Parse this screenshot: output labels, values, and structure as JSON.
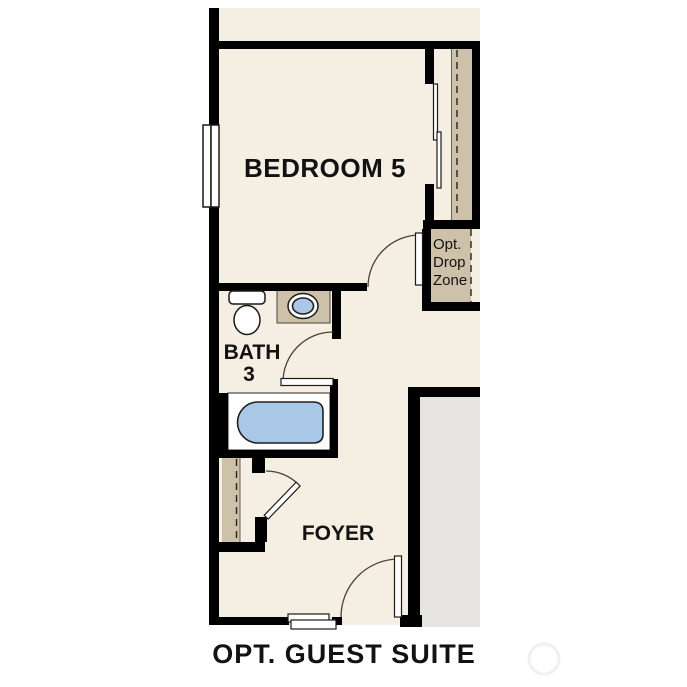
{
  "caption": {
    "title": "OPT. GUEST SUITE"
  },
  "rooms": {
    "bedroom": {
      "label": "BEDROOM 5"
    },
    "bath": {
      "label_line1": "BATH",
      "label_line2": "3"
    },
    "foyer": {
      "label": "FOYER"
    },
    "drop_zone": {
      "label_line1": "Opt.",
      "label_line2": "Drop",
      "label_line3": "Zone"
    }
  },
  "fixtures": {
    "window": "window-icon",
    "sliding_closet_doors": "sliding-door-icon",
    "toilet": "toilet-icon",
    "sink": "sink-icon",
    "bathtub": "bathtub-icon",
    "doors": "door-swing-icon",
    "entry_step": "entry-step-icon"
  },
  "colors": {
    "floor_cream": "#f5eee2",
    "closet_tan": "#cdc1aa",
    "adjacent_gray": "#e5e4e1",
    "fixture_blue": "#a9c8e8",
    "wall_black": "#000000"
  }
}
